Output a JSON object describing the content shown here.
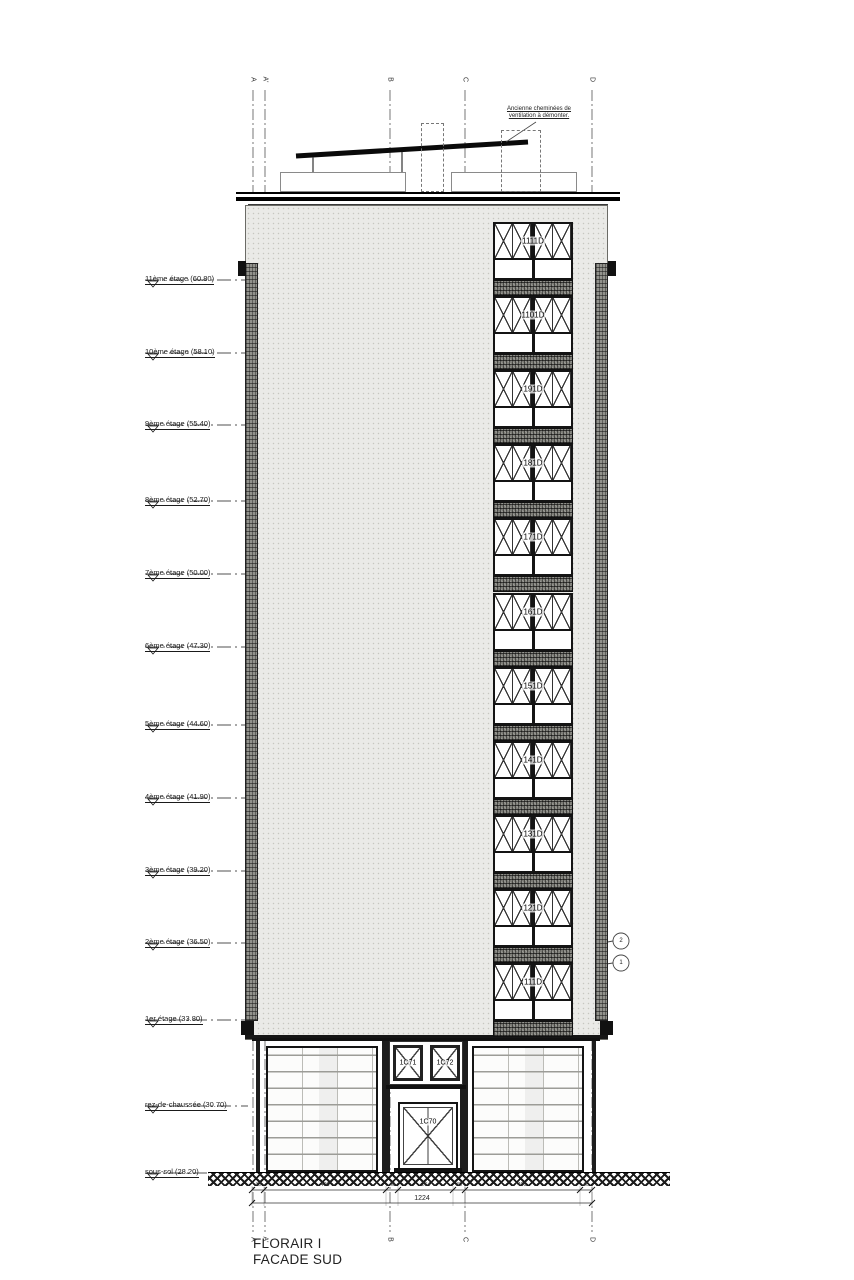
{
  "title": {
    "project": "FLORAIR I",
    "drawing": "FACADE SUD"
  },
  "roof_note": {
    "line1": "Ancienne cheminées de",
    "line2": "ventilation à démonter."
  },
  "grid_labels": {
    "top": [
      "A",
      "A'",
      "B",
      "C",
      "D"
    ],
    "bottom": [
      "A",
      "A'",
      "B",
      "C",
      "D"
    ]
  },
  "levels": [
    {
      "label": "11ème étage (60.80)"
    },
    {
      "label": "10ème étage (58.10)"
    },
    {
      "label": "9ème étage (55.40)"
    },
    {
      "label": "8ème étage (52.70)"
    },
    {
      "label": "7ème étage (50.00)"
    },
    {
      "label": "6ème étage (47.30)"
    },
    {
      "label": "5ème étage (44.60)"
    },
    {
      "label": "4ème étage (41.90)"
    },
    {
      "label": "3ème étage (39.20)"
    },
    {
      "label": "2ème étage (36.50)"
    },
    {
      "label": "1er étage (33.80)"
    },
    {
      "label": "rez-de-chaussée (30.70)"
    },
    {
      "label": "sous-sol (28.20)"
    }
  ],
  "windows": [
    {
      "label": "1111D"
    },
    {
      "label": "1101D"
    },
    {
      "label": "191D"
    },
    {
      "label": "181D"
    },
    {
      "label": "171D"
    },
    {
      "label": "161D"
    },
    {
      "label": "151D"
    },
    {
      "label": "141D"
    },
    {
      "label": "131D"
    },
    {
      "label": "121D"
    },
    {
      "label": "111D"
    }
  ],
  "ground_floor": {
    "window_left": "1C71",
    "window_right": "1C72",
    "door": "1C70"
  },
  "callouts": [
    {
      "number": "2"
    },
    {
      "number": "1"
    }
  ],
  "dimensions": {
    "segments": [
      "40",
      "400",
      "40",
      "264",
      "40",
      "400",
      "40"
    ],
    "total": "1224"
  },
  "colors": {
    "line": "#1a1a1a",
    "facade": "#eaeae7",
    "spandrel": "#7d7d77",
    "paper": "#ffffff"
  }
}
